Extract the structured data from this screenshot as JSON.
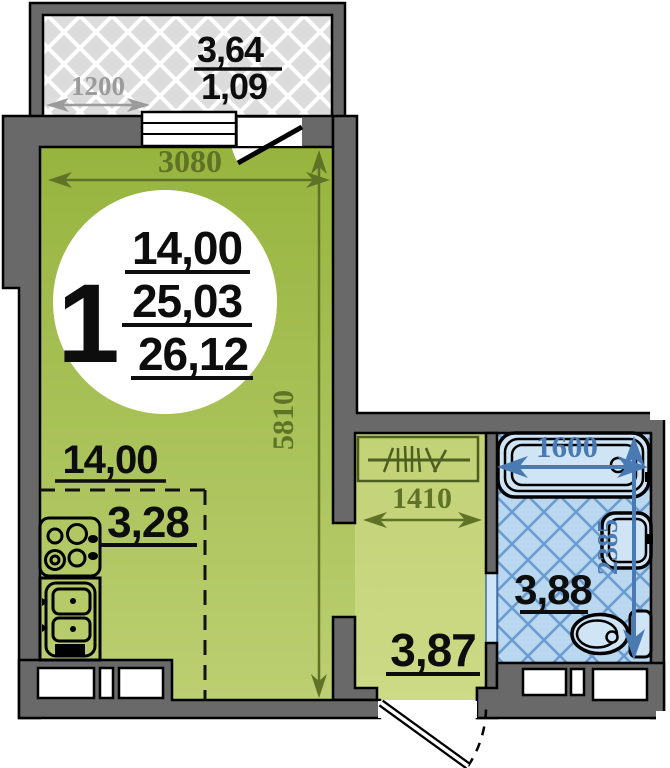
{
  "floor_plan": {
    "unit_badge": {
      "number": "1",
      "living_area": "14,00",
      "total_area": "25,03",
      "total_area_with_balcony": "26,12"
    },
    "rooms": {
      "main_room_area": "14,00",
      "kitchen_zone_area": "3,28",
      "hallway_area": "3,87",
      "bathroom_area": "3,88",
      "balcony_area": "3,64",
      "balcony_reduced_area": "1,09"
    },
    "dimensions": {
      "room_width": "3080",
      "room_length": "5810",
      "balcony_width": "1200",
      "hallway_width": "1410",
      "bathroom_width": "1600",
      "bathroom_length": "2385"
    },
    "colors": {
      "wall_gray": "#696969",
      "room_green_top": "#96b43e",
      "room_green_bottom": "#bccf72",
      "hall_green": "#c7d67c",
      "balcony_gray": "#dcdcdc",
      "bath_blue": "#b9d8ef",
      "bath_lattice_blue": "#6b9bd0",
      "dim_olive": "#5f7226",
      "dim_gray": "#9b9b9b",
      "dim_blue": "#4a7ab2",
      "label_black": "#0d0d0d"
    }
  }
}
